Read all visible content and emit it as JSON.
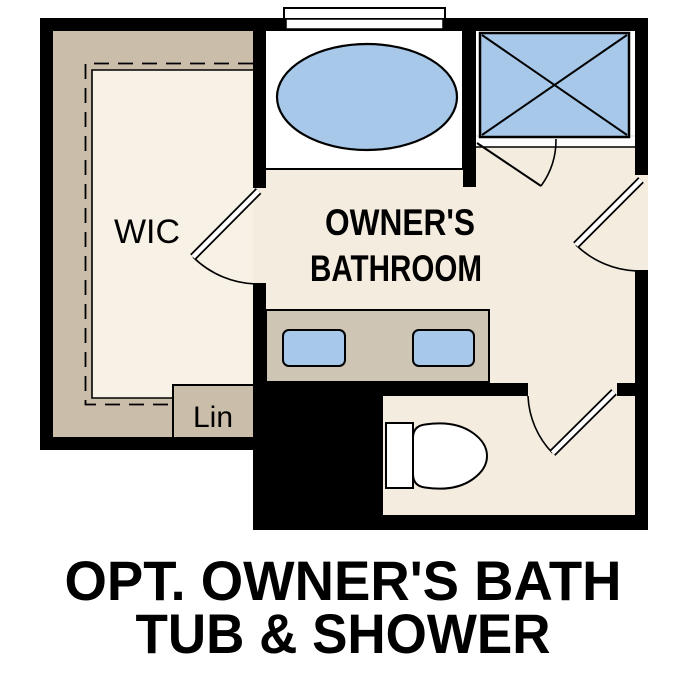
{
  "floor_plan": {
    "rooms": {
      "wic_label": "WIC",
      "bathroom_label_line1": "OWNER'S",
      "bathroom_label_line2": "BATHROOM",
      "linen_label": "Lin"
    },
    "caption": {
      "line1": "OPT. OWNER'S BATH",
      "line2": "TUB & SHOWER"
    },
    "colors": {
      "background": "#ffffff",
      "wall": "#000000",
      "bath_floor": "#f3ecdf",
      "closet_floor": "#f8f2e6",
      "casework_tan": "#cabeaa",
      "vanity_tan": "#cec5b4",
      "fixture_blue": "#a7c8e8",
      "outline": "#000000",
      "label_text": "#000000"
    }
  }
}
